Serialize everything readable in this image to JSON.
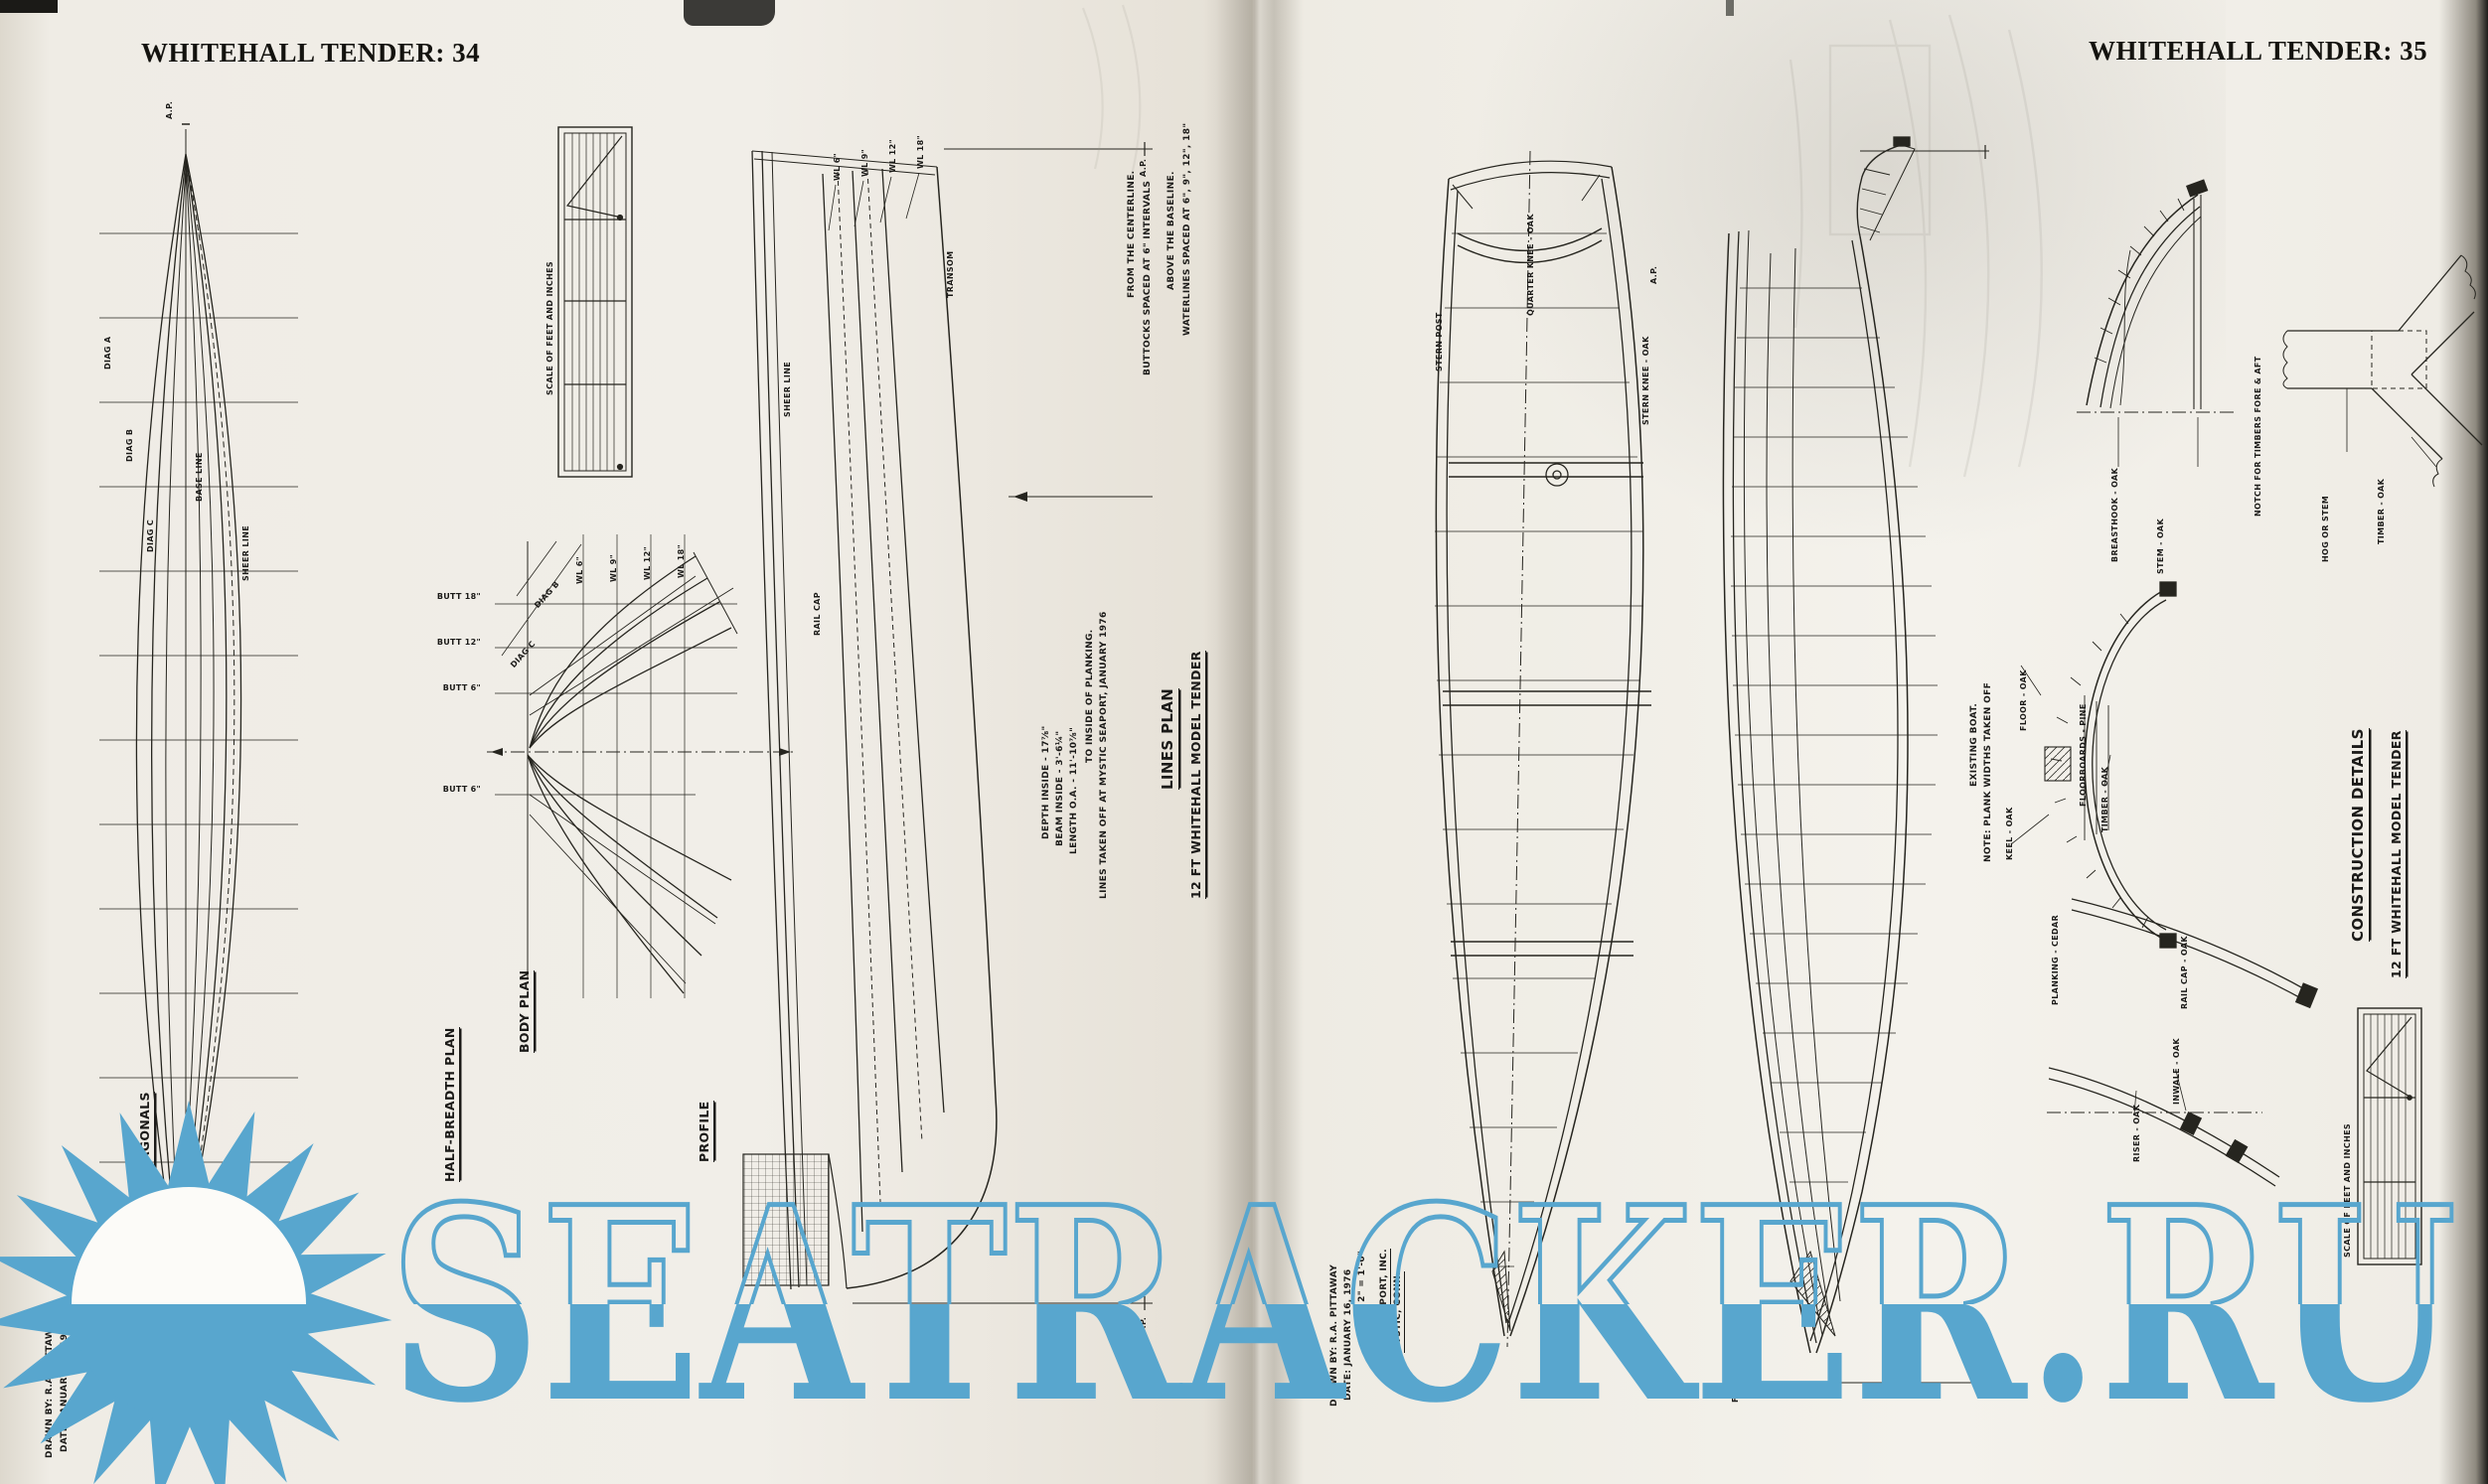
{
  "watermark": {
    "text": "SEATRACKER.RU",
    "color": "#58a6ce"
  },
  "left": {
    "header": "WHITEHALL TENDER: 34",
    "title1": "12 FT WHITEHALL MODEL TENDER",
    "title2": "LINES PLAN",
    "note_waterlines_1": "WATERLINES SPACED AT 6\", 9\", 12\", 18\"",
    "note_waterlines_2": "ABOVE THE BASELINE.",
    "note_buttocks_1": "BUTTOCKS SPACED AT 6\" INTERVALS",
    "note_buttocks_2": "FROM THE CENTERLINE.",
    "note_lines_1": "LINES TAKEN OFF AT MYSTIC SEAPORT, JANUARY 1976",
    "note_lines_2": "TO INSIDE OF PLANKING.",
    "dim_length": "LENGTH O.A.  -  11'-10⅞\"",
    "dim_beam": "BEAM INSIDE  -  3'-6¼\"",
    "dim_depth": "DEPTH INSIDE  -  17⅞\"",
    "scale_caption": "SCALE OF FEET AND INCHES",
    "label_diagonals": "DIAGONALS",
    "label_body_plan": "BODY PLAN",
    "label_half_breadth": "HALF-BREADTH PLAN",
    "label_profile": "PROFILE",
    "wl": [
      "WL 6\"",
      "WL 9\"",
      "WL 12\"",
      "WL 18\""
    ],
    "butt": [
      "BUTT 18\"",
      "BUTT 12\"",
      "BUTT 6\"",
      "BUTT 6\""
    ],
    "diag": [
      "DIAG A",
      "DIAG B",
      "DIAG C"
    ],
    "misc": {
      "sheer": "SHEER LINE",
      "rail": "RAIL CAP",
      "transom": "TRANSOM",
      "base": "BASE LINE",
      "ap": "A.P.",
      "fp": "F.P."
    },
    "credits": {
      "org1": "MYSTIC SEAPORT",
      "org2": "MYSTIC, CONN.",
      "drawn": "DRAWN BY: R.A. PITTAWAY",
      "date": "DATE: JANUARY 16, 1976",
      "scale": "SCALE: 2\" = 1'-0\""
    }
  },
  "right": {
    "header": "WHITEHALL TENDER: 35",
    "title1": "12 FT WHITEHALL MODEL TENDER",
    "title2": "CONSTRUCTION DETAILS",
    "note1": "NOTE: PLANK WIDTHS TAKEN OFF",
    "note2": "EXISTING BOAT.",
    "scale_caption": "SCALE OF FEET AND INCHES",
    "labels": {
      "quarter_knee": "QUARTER KNEE - OAK",
      "stern_post": "STERN POST",
      "stern_knee": "STERN KNEE - OAK",
      "breasthook": "BREASTHOOK - OAK",
      "stem": "STEM - OAK",
      "notch": "NOTCH FOR TIMBERS FORE & AFT",
      "hog": "HOG OR STEM",
      "timber": "TIMBER - OAK",
      "floor": "FLOOR - OAK",
      "floorboards": "FLOORBOARDS - PINE",
      "keel": "KEEL - OAK",
      "planking": "PLANKING - CEDAR",
      "rail_cap": "RAIL CAP - OAK",
      "riser": "RISER - OAK",
      "inwale": "INWALE - OAK",
      "ap": "A.P.",
      "fp": "F.P."
    },
    "credits": {
      "org1": "MYSTIC SEAPORT, INC.",
      "org2": "MYSTIC, CONN.",
      "drawn": "DRAWN BY: R.A. PITTAWAY",
      "date": "DATE: JANUARY 16, 1976",
      "scale": "SCALE: 2\" = 1'-0\""
    }
  }
}
